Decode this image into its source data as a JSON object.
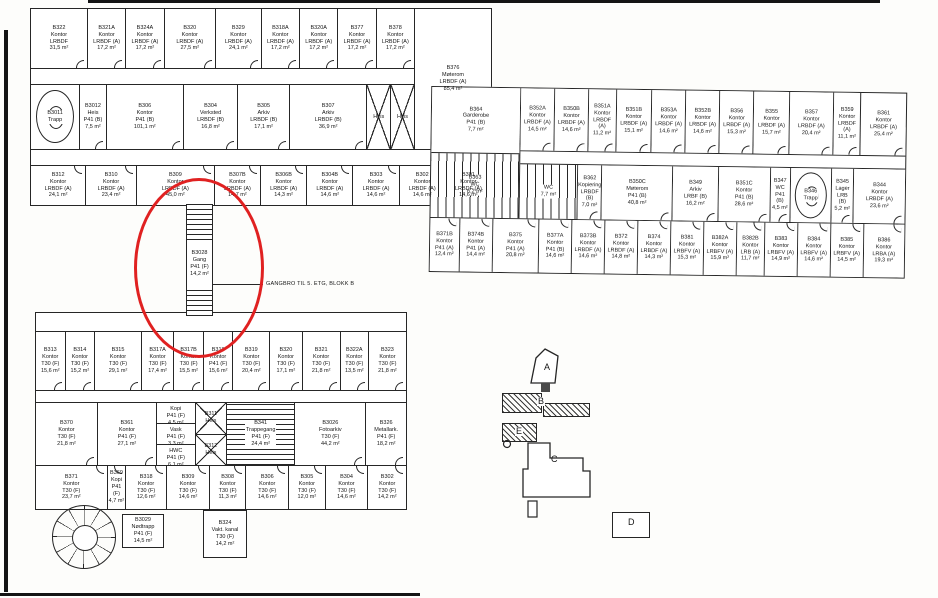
{
  "annotation": {
    "ellipse_color": "#e02121",
    "callout": "GANGBRO TIL 5. ETG, BLOKK B"
  },
  "connector": {
    "id": "B3028",
    "use": "Gang",
    "cls": "P41 (F)",
    "area": "14,2 m²"
  },
  "keyplan": {
    "a": "A",
    "b": "B",
    "c": "C",
    "d": "D",
    "e": "E"
  },
  "top_wing": {
    "row1": [
      {
        "id": "B322",
        "use": "Kontor",
        "cls": "LRBDF",
        "area": "31,5 m²",
        "w": 1.5
      },
      {
        "id": "B321A",
        "use": "Kontor",
        "cls": "LRBDF (A)",
        "area": "17,2 m²",
        "w": 1
      },
      {
        "id": "B324A",
        "use": "Kontor",
        "cls": "LRBDF (A)",
        "area": "17,2 m²",
        "w": 1
      },
      {
        "id": "B320",
        "use": "Kontor",
        "cls": "LRBDF (A)",
        "area": "27,5 m²",
        "w": 1.35
      },
      {
        "id": "B329",
        "use": "Kontor",
        "cls": "LRBDF (A)",
        "area": "24,1 m²",
        "w": 1.2
      },
      {
        "id": "B318A",
        "use": "Kontor",
        "cls": "LRBDF (A)",
        "area": "17,2 m²",
        "w": 1
      },
      {
        "id": "B320A",
        "use": "Kontor",
        "cls": "LRBDF (A)",
        "area": "17,2 m²",
        "w": 1
      },
      {
        "id": "B377",
        "use": "Kontor",
        "cls": "LRBDF (A)",
        "area": "17,2 m²",
        "w": 1
      },
      {
        "id": "B378",
        "use": "Kontor",
        "cls": "LRBDF (A)",
        "area": "17,2 m²",
        "w": 1
      }
    ],
    "big_room": [
      {
        "id": "B376",
        "use": "Møterom",
        "cls": "LRBDF (A)",
        "area": "85,4 m²",
        "w": 1
      }
    ],
    "row2": [
      {
        "special": "round-stair",
        "id": "B3011",
        "use": "Trapp",
        "w": 0.95
      },
      {
        "id": "B3012",
        "use": "Heis",
        "cls": "P41 (B)",
        "area": "7,5 m²",
        "w": 0.5
      },
      {
        "id": "B306",
        "use": "Kontor",
        "cls": "P41 (B)",
        "area": "101,1 m²",
        "w": 1.5
      },
      {
        "id": "B304",
        "use": "Verksted",
        "cls": "LRBDF (B)",
        "area": "16,8 m²",
        "w": 1.05
      },
      {
        "id": "B305",
        "use": "Arkiv",
        "cls": "LRBDF (B)",
        "area": "17,1 m²",
        "w": 1
      },
      {
        "id": "B307",
        "use": "Arkiv",
        "cls": "LRBDF (B)",
        "area": "36,9 m²",
        "w": 1.5
      },
      {
        "special": "lift",
        "use": "Heis",
        "w": 0.45
      },
      {
        "special": "lift",
        "use": "Heis",
        "w": 0.45
      }
    ],
    "row3": [
      {
        "id": "B312",
        "use": "Kontor",
        "cls": "LRBDF (A)",
        "area": "24,1 m²",
        "w": 1.2
      },
      {
        "id": "B310",
        "use": "Kontor",
        "cls": "LRBDF (A)",
        "area": "23,4 m²",
        "w": 1.1
      },
      {
        "id": "B309",
        "use": "Kontor",
        "cls": "LRBDF (A)",
        "area": "45,0 m²",
        "w": 1.7
      },
      {
        "id": "B307B",
        "use": "Kontor",
        "cls": "LRBDF (A)",
        "area": "14,7 m²",
        "w": 1
      },
      {
        "id": "B306B",
        "use": "Kontor",
        "cls": "LRBDF (A)",
        "area": "14,3 m²",
        "w": 1
      },
      {
        "id": "B304B",
        "use": "Kontor",
        "cls": "LRBDF (A)",
        "area": "14,6 m²",
        "w": 1
      },
      {
        "id": "B303",
        "use": "Kontor",
        "cls": "LRBDF (A)",
        "area": "14,6 m²",
        "w": 1
      },
      {
        "id": "B302",
        "use": "Kontor",
        "cls": "LRBDF (A)",
        "area": "14,6 m²",
        "w": 1
      },
      {
        "id": "B301",
        "use": "Kontor",
        "cls": "LRBDF (A)",
        "area": "14,6 m²",
        "w": 1
      }
    ]
  },
  "right_wing": {
    "junction": [
      {
        "id": "B364",
        "use": "Garderobe",
        "cls": "P41 (B)",
        "area": "7,7 m²"
      },
      {
        "special": "wc",
        "id": "B363",
        "use": "WC",
        "area": "6,2 m²"
      }
    ],
    "row1": [
      {
        "id": "B352A",
        "use": "Kontor",
        "cls": "LRBDF (A)",
        "area": "14,5 m²",
        "w": 1
      },
      {
        "id": "B350B",
        "use": "Kontor",
        "cls": "LRBDF (A)",
        "area": "14,6 m²",
        "w": 1
      },
      {
        "id": "B351A",
        "use": "Kontor",
        "cls": "LRBDF (A)",
        "area": "11,2 m²",
        "w": 0.8
      },
      {
        "id": "B351B",
        "use": "Kontor",
        "cls": "LRBDF (A)",
        "area": "15,1 m²",
        "w": 1.05
      },
      {
        "id": "B353A",
        "use": "Kontor",
        "cls": "LRBDF (A)",
        "area": "14,6 m²",
        "w": 1
      },
      {
        "id": "B352B",
        "use": "Kontor",
        "cls": "LRBDF (A)",
        "area": "14,6 m²",
        "w": 1
      },
      {
        "id": "B356",
        "use": "Kontor",
        "cls": "LRBDF (A)",
        "area": "15,3 m²",
        "w": 1
      },
      {
        "id": "B355",
        "use": "Kontor",
        "cls": "LRBDF (A)",
        "area": "15,7 m²",
        "w": 1.05
      },
      {
        "id": "B357",
        "use": "Kontor",
        "cls": "LRBDF (A)",
        "area": "20,4 m²",
        "w": 1.3
      },
      {
        "id": "B359",
        "use": "Kontor",
        "cls": "LRBDF (A)",
        "area": "11,1 m²",
        "w": 0.8
      },
      {
        "special": "angled",
        "id": "B361",
        "use": "Kontor",
        "cls": "LRBDF (A)",
        "area": "25,4 m²",
        "w": 1.35
      }
    ],
    "row2": [
      {
        "special": "wc",
        "use": "WC",
        "area": "7,7 m²",
        "w": 1.35
      },
      {
        "id": "B362",
        "use": "Kopiering",
        "cls": "LRBDF (B)",
        "area": "7,0 m²",
        "w": 0.55
      },
      {
        "id": "B350C",
        "use": "Møterom",
        "cls": "P41 (B)",
        "area": "40,8 m²",
        "w": 1.65
      },
      {
        "id": "B349",
        "use": "Arkiv",
        "cls": "LRBF (B)",
        "area": "16,2 m²",
        "w": 1.05
      },
      {
        "id": "B351C",
        "use": "Kontor",
        "cls": "P41 (B)",
        "area": "28,6 m²",
        "w": 1.2
      },
      {
        "id": "B347",
        "use": "WC",
        "cls": "P41 (B)",
        "area": "4,5 m²",
        "w": 0.45
      },
      {
        "special": "round-stair",
        "id": "B346",
        "use": "Trapp",
        "w": 0.95
      },
      {
        "id": "B345",
        "use": "Lager",
        "cls": "LRB (B)",
        "area": "5,2 m²",
        "w": 0.5
      },
      {
        "id": "B344",
        "use": "Kontor",
        "cls": "LRBDF (A)",
        "area": "23,6 m²",
        "w": 1.2
      }
    ],
    "row3": [
      {
        "id": "B371B",
        "use": "Kontor",
        "cls": "P41 (A)",
        "area": "12,4 m²",
        "w": 0.85
      },
      {
        "id": "B374B",
        "use": "Kontor",
        "cls": "P41 (A)",
        "area": "14,4 m²",
        "w": 0.95
      },
      {
        "id": "B375",
        "use": "Kontor",
        "cls": "P41 (A)",
        "area": "20,8 m²",
        "w": 1.35
      },
      {
        "id": "B377A",
        "use": "Kontor",
        "cls": "P41 (B)",
        "area": "14,6 m²",
        "w": 0.95
      },
      {
        "id": "B373B",
        "use": "Kontor",
        "cls": "LRBDF (A)",
        "area": "14,6 m²",
        "w": 0.95
      },
      {
        "id": "B372",
        "use": "Kontor",
        "cls": "LRBDF (A)",
        "area": "14,8 m²",
        "w": 0.95
      },
      {
        "id": "B374",
        "use": "Kontor",
        "cls": "LRBDF (A)",
        "area": "14,3 m²",
        "w": 0.95
      },
      {
        "id": "B381",
        "use": "Kontor",
        "cls": "LRBFV (A)",
        "area": "15,3 m²",
        "w": 0.95
      },
      {
        "id": "B382A",
        "use": "Kontor",
        "cls": "LRBFV (A)",
        "area": "15,9 m²",
        "w": 0.95
      },
      {
        "id": "B382B",
        "use": "Kontor",
        "cls": "LRB (A)",
        "area": "11,7 m²",
        "w": 0.8
      },
      {
        "id": "B383",
        "use": "Kontor",
        "cls": "LRBFV (A)",
        "area": "14,9 m²",
        "w": 0.95
      },
      {
        "id": "B384",
        "use": "Kontor",
        "cls": "LRBFV (A)",
        "area": "14,6 m²",
        "w": 0.95
      },
      {
        "id": "B385",
        "use": "Kontor",
        "cls": "LRBFV (A)",
        "area": "14,5 m²",
        "w": 0.95
      },
      {
        "id": "B386",
        "use": "Kontor",
        "cls": "LRBA (A)",
        "area": "19,3 m²",
        "w": 1.2
      }
    ]
  },
  "bottom_wing": {
    "row1": [
      {
        "id": "B313",
        "use": "Kontor",
        "cls": "T30 (F)",
        "area": "15,6 m²",
        "w": 1
      },
      {
        "id": "B314",
        "use": "Kontor",
        "cls": "T30 (F)",
        "area": "15,2 m²",
        "w": 1
      },
      {
        "id": "B315",
        "use": "Kontor",
        "cls": "T30 (F)",
        "area": "29,1 m²",
        "w": 1.6
      },
      {
        "id": "B317A",
        "use": "Kontor",
        "cls": "T30 (F)",
        "area": "17,4 m²",
        "w": 1.1
      },
      {
        "id": "B317B",
        "use": "Kontor",
        "cls": "T30 (F)",
        "area": "15,5 m²",
        "w": 1
      },
      {
        "id": "B318",
        "use": "Kontor",
        "cls": "P41 (F)",
        "area": "15,6 m²",
        "w": 1
      },
      {
        "id": "B319",
        "use": "Kontor",
        "cls": "T30 (F)",
        "area": "20,4 m²",
        "w": 1.25
      },
      {
        "id": "B320",
        "use": "Kontor",
        "cls": "T30 (F)",
        "area": "17,1 m²",
        "w": 1.1
      },
      {
        "id": "B321",
        "use": "Kontor",
        "cls": "T30 (F)",
        "area": "21,8 m²",
        "w": 1.3
      },
      {
        "id": "B322A",
        "use": "Kontor",
        "cls": "T30 (F)",
        "area": "13,5 m²",
        "w": 0.95
      },
      {
        "id": "B323",
        "use": "Kontor",
        "cls": "T30 (F)",
        "area": "21,8 m²",
        "w": 1.3
      }
    ],
    "mid": [
      {
        "id": "B370",
        "use": "Kontor",
        "cls": "T30 (F)",
        "area": "21,8 m²",
        "w": 1.0
      },
      {
        "id": "B361",
        "use": "Kontor",
        "cls": "P41 (F)",
        "area": "27,1 m²",
        "w": 0.95
      },
      {
        "special": "stack",
        "w": 0.62,
        "items": [
          {
            "id": "B328",
            "use": "Kopi",
            "cls": "P41 (F)",
            "area": "4,5 m²"
          },
          {
            "id": "B327",
            "use": "Vask",
            "cls": "P41 (F)",
            "area": "3,3 m²"
          },
          {
            "id": "B325",
            "use": "HWC",
            "cls": "P41 (F)",
            "area": "6,1 m²"
          }
        ]
      },
      {
        "special": "stack",
        "w": 0.5,
        "items": [
          {
            "special": "lift",
            "id": "B311",
            "use": "Heis"
          },
          {
            "special": "lift",
            "id": "B312",
            "use": "Heis"
          }
        ]
      },
      {
        "special": "stair-h",
        "id": "B341",
        "use": "Trappegang",
        "cls": "P41 (F)",
        "area": "24,4 m²",
        "w": 1.1
      },
      {
        "id": "B3026",
        "use": "Fotoarkiv",
        "cls": "T30 (F)",
        "area": "44,2 m²",
        "w": 1.15
      },
      {
        "id": "B326",
        "use": "Metallark.",
        "cls": "P41 (F)",
        "area": "18,2 m²",
        "w": 0.65
      }
    ],
    "row3": [
      {
        "id": "B371",
        "use": "Kontor",
        "cls": "T30 (F)",
        "area": "23,7 m²",
        "w": 1.6
      },
      {
        "id": "B369",
        "use": "Kopi",
        "cls": "P41 (F)",
        "area": "4,7 m²",
        "w": 0.4
      },
      {
        "id": "B318",
        "use": "Kontor",
        "cls": "T30 (F)",
        "area": "12,6 m²",
        "w": 0.9
      },
      {
        "id": "B309",
        "use": "Kontor",
        "cls": "T30 (F)",
        "area": "14,6 m²",
        "w": 0.95
      },
      {
        "id": "B308",
        "use": "Kontor",
        "cls": "T30 (F)",
        "area": "11,3 m²",
        "w": 0.8
      },
      {
        "id": "B306",
        "use": "Kontor",
        "cls": "T30 (F)",
        "area": "14,6 m²",
        "w": 0.95
      },
      {
        "id": "B305",
        "use": "Kontor",
        "cls": "T30 (F)",
        "area": "12,0 m²",
        "w": 0.8
      },
      {
        "id": "B304",
        "use": "Kontor",
        "cls": "T30 (F)",
        "area": "14,6 m²",
        "w": 0.95
      },
      {
        "id": "B302",
        "use": "Kontor",
        "cls": "T30 (F)",
        "area": "14,2 m²",
        "w": 0.85
      }
    ],
    "nodtrapp": [
      {
        "id": "B3029",
        "use": "Nødtrapp",
        "cls": "P41 (F)",
        "area": "14,5 m²"
      }
    ],
    "vakt": [
      {
        "id": "B324",
        "use": "Vakt. kanal",
        "cls": "T30 (F)",
        "area": "14,2 m²"
      }
    ]
  }
}
